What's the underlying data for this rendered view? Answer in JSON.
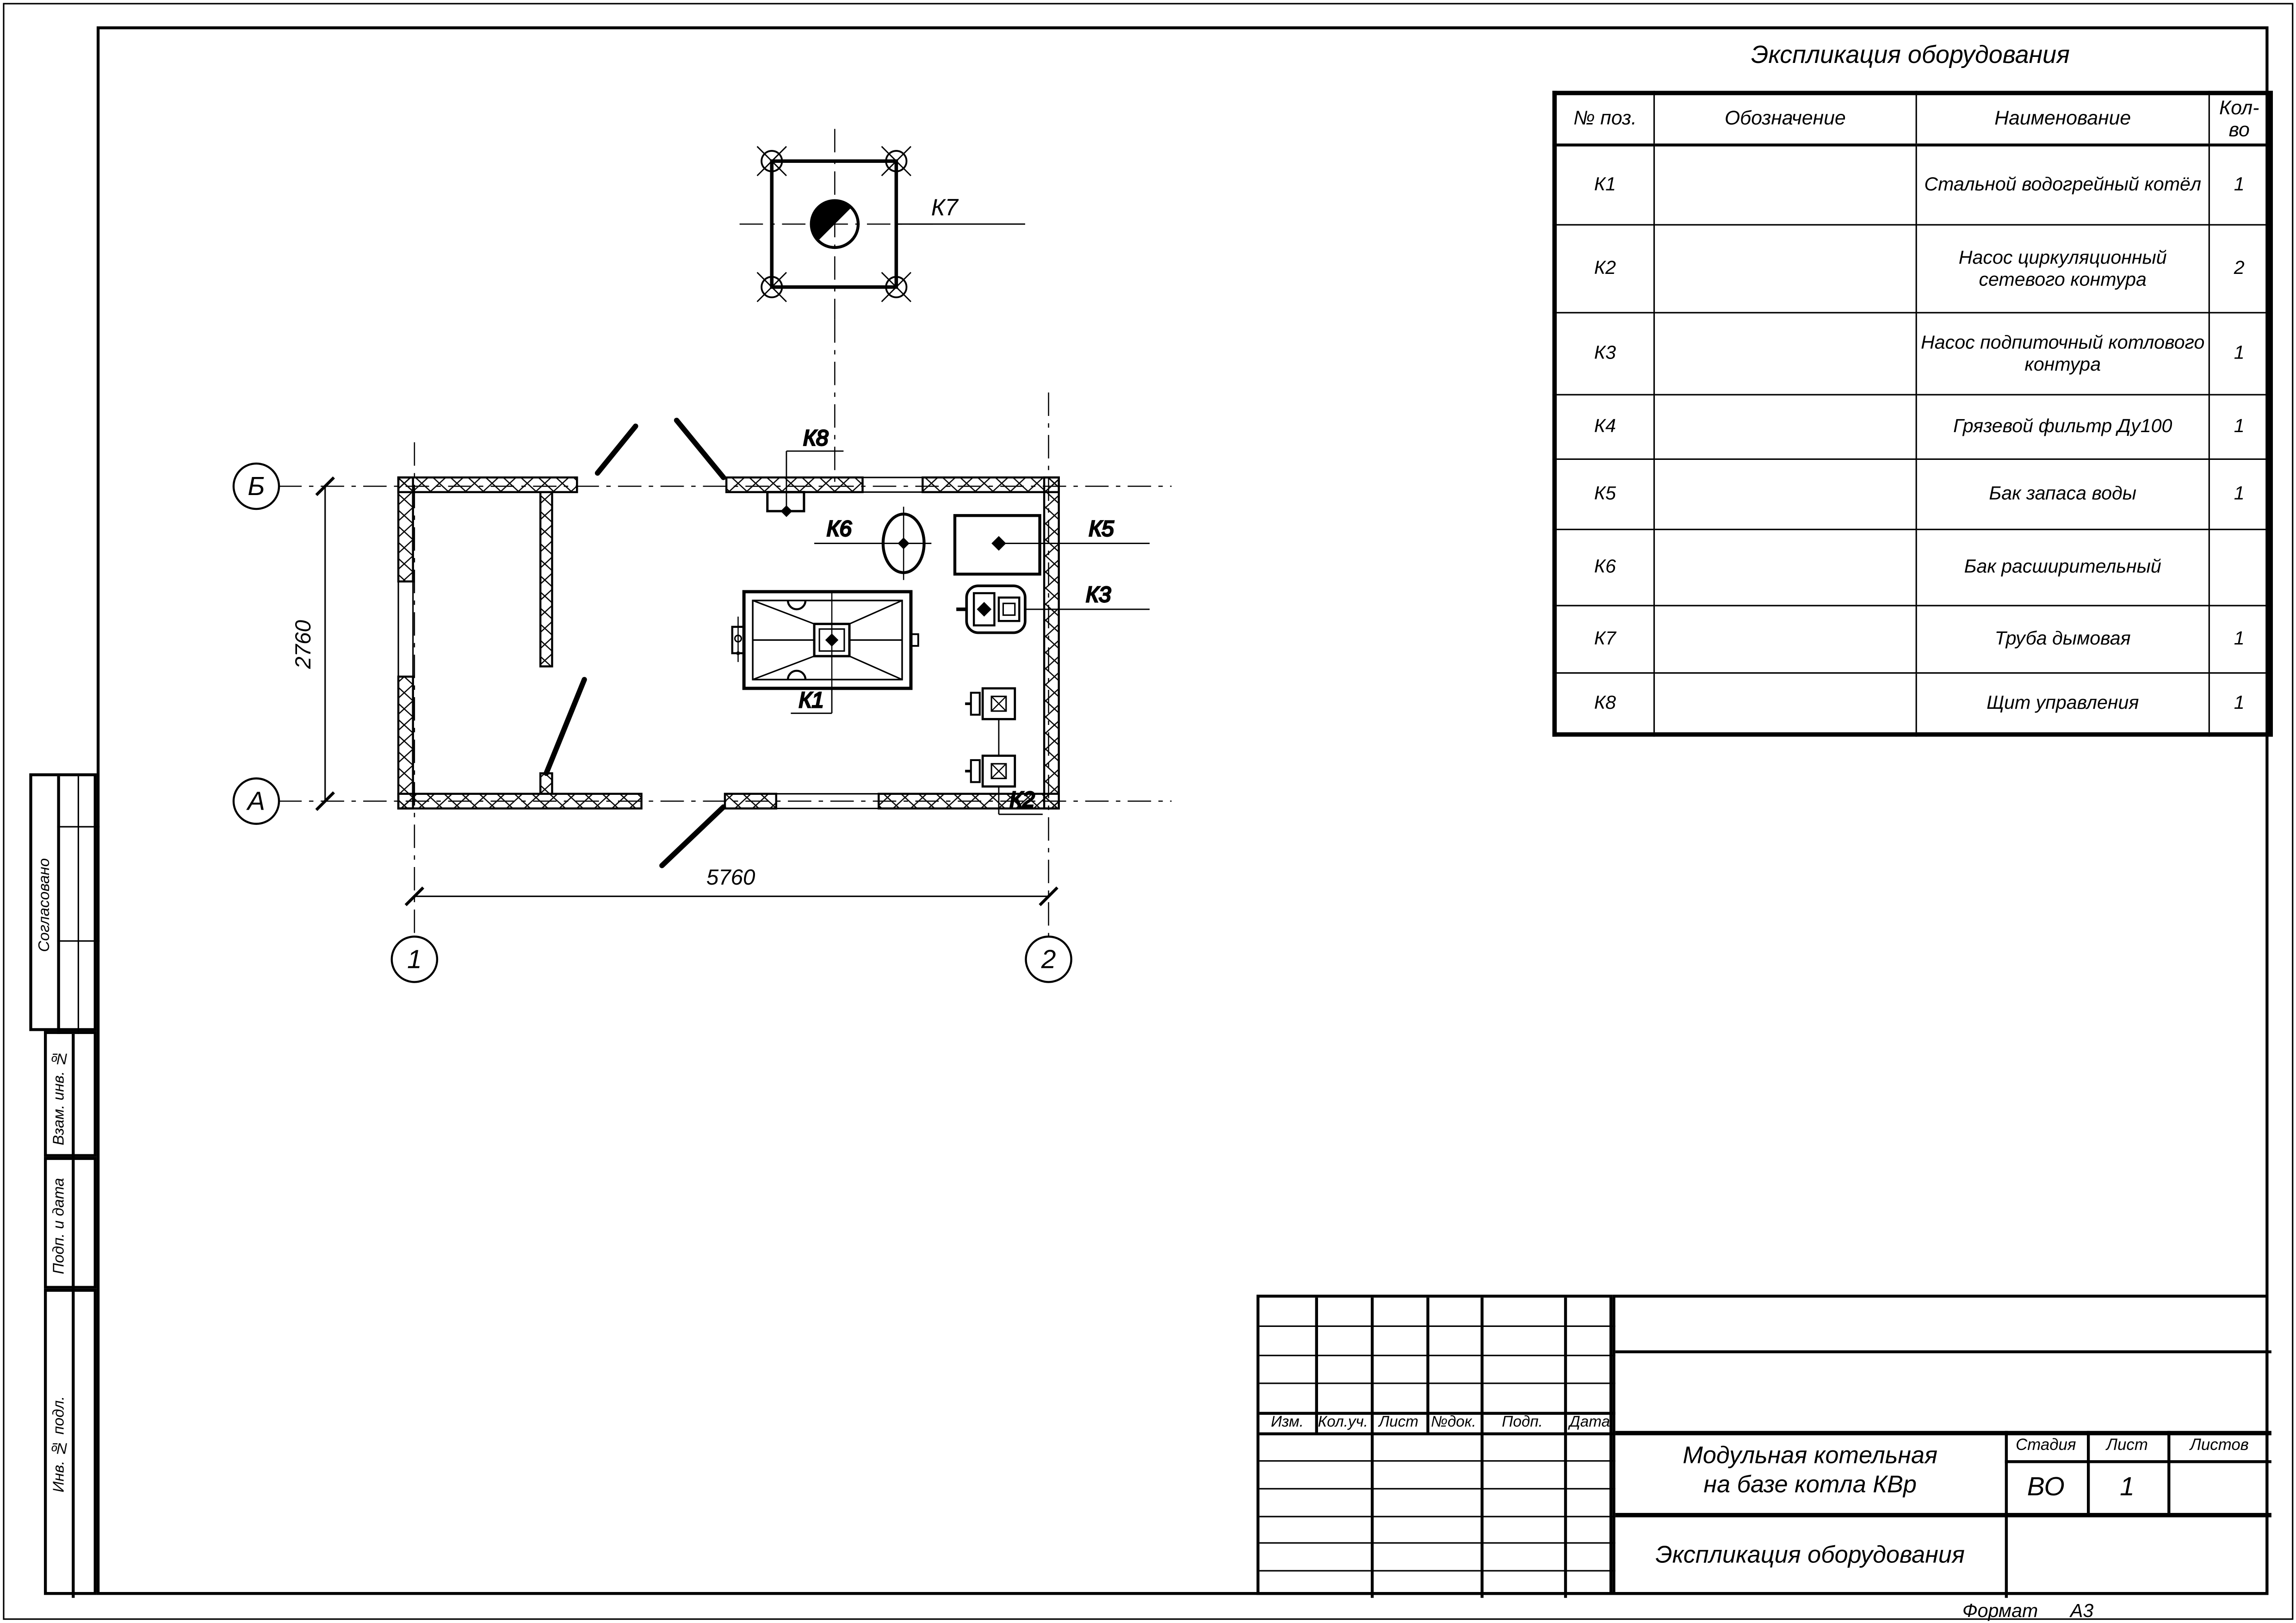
{
  "sheet": {
    "format_label": "Формат",
    "format_value": "А3"
  },
  "equipment_table": {
    "title": "Экспликация оборудования",
    "columns": {
      "pos": "№ поз.",
      "designation": "Обозначение",
      "name": "Наименование",
      "qty": "Кол-во"
    },
    "rows": [
      {
        "pos": "К1",
        "designation": "",
        "name": "Стальной водогрейный котёл",
        "qty": "1"
      },
      {
        "pos": "К2",
        "designation": "",
        "name": "Насос циркуляционный\nсетевого контура",
        "qty": "2"
      },
      {
        "pos": "К3",
        "designation": "",
        "name": "Насос подпиточный котлового\nконтура",
        "qty": "1"
      },
      {
        "pos": "К4",
        "designation": "",
        "name": "Грязевой фильтр Ду100",
        "qty": "1"
      },
      {
        "pos": "К5",
        "designation": "",
        "name": "Бак запаса воды",
        "qty": "1"
      },
      {
        "pos": "К6",
        "designation": "",
        "name": "Бак расширительный",
        "qty": ""
      },
      {
        "pos": "К7",
        "designation": "",
        "name": "Труба дымовая",
        "qty": "1"
      },
      {
        "pos": "К8",
        "designation": "",
        "name": "Щит управления",
        "qty": "1"
      }
    ]
  },
  "plan": {
    "axes": {
      "row_top": "Б",
      "row_bottom": "А",
      "col_left": "1",
      "col_right": "2"
    },
    "dimensions": {
      "width": "5760",
      "height": "2760"
    },
    "labels": {
      "k1": "К1",
      "k2": "К2",
      "k3": "К3",
      "k5": "К5",
      "k6": "К6",
      "k7": "К7",
      "k8": "К8"
    }
  },
  "sidebar": {
    "agreed": "Согласовано",
    "vzam": "Взам. инв. №",
    "podp": "Подп. и дата",
    "inv": "Инв. № подл."
  },
  "title_block": {
    "cols": {
      "izm": "Изм.",
      "koluch": "Кол.уч.",
      "list": "Лист",
      "ndok": "№док.",
      "podp": "Подп.",
      "data": "Дата"
    },
    "project_title": "Модульная котельная\nна базе котла КВр",
    "doc_title": "Экспликация оборудования",
    "stage_label": "Стадия",
    "sheet_label": "Лист",
    "sheets_label": "Листов",
    "stage_value": "ВО",
    "sheet_value": "1",
    "sheets_value": ""
  }
}
